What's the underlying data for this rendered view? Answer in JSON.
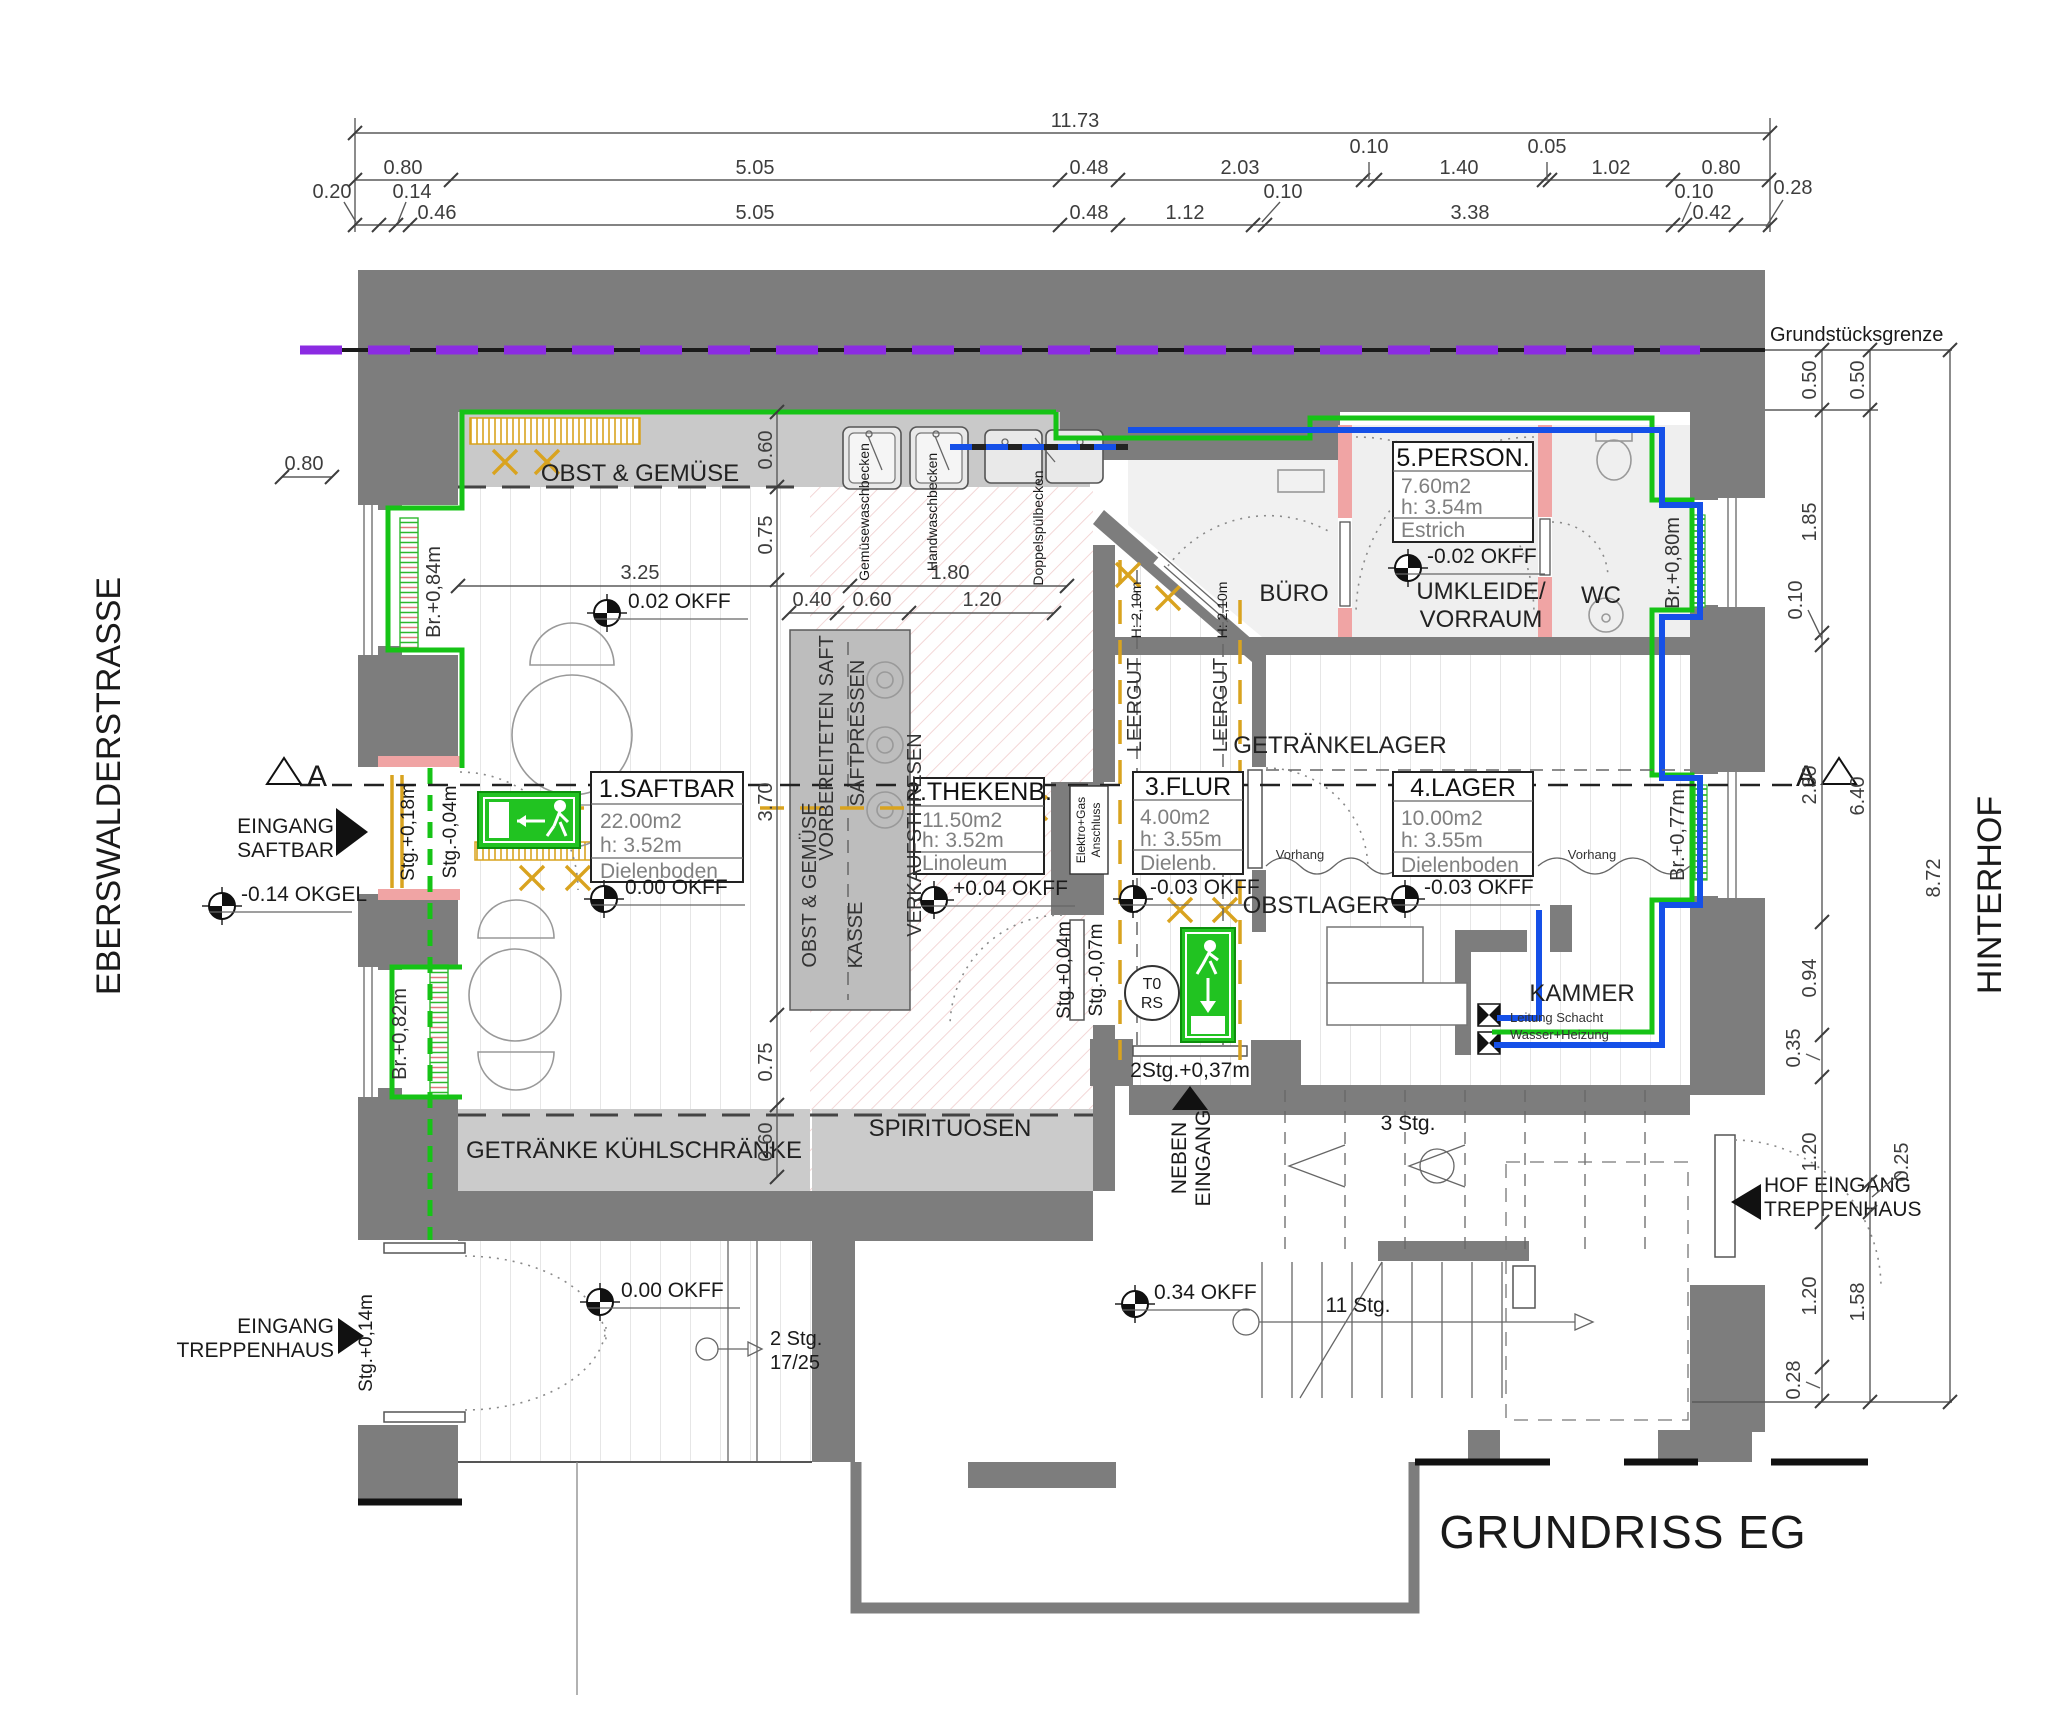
{
  "title": "GRUNDRISS EG",
  "context": {
    "street_left": "EBERSWALDERSTRASSE",
    "street_right": "HINTERHOF",
    "property_line": "Grundstücksgrenze",
    "section": "A"
  },
  "rooms": [
    {
      "name": "1.SAFTBAR",
      "area": "22.00m2",
      "height": "h: 3.52m",
      "floor": "Dielenboden"
    },
    {
      "name": "2.THEKENB.",
      "area": "11.50m2",
      "height": "h: 3.52m",
      "floor": "Linoleum"
    },
    {
      "name": "3.FLUR",
      "area": "4.00m2",
      "height": "h: 3.55m",
      "floor": "Dielenb."
    },
    {
      "name": "4.LAGER",
      "area": "10.00m2",
      "height": "h: 3.55m",
      "floor": "Dielenboden"
    },
    {
      "name": "5.PERSON.",
      "area": "7.60m2",
      "height": "h: 3.54m",
      "floor": "Estrich"
    }
  ],
  "zones": {
    "obst_shelf": "OBST & GEMÜSE",
    "getraenke": "GETRÄNKE KÜHLSCHRÄNKE",
    "spirituosen": "SPIRITUOSEN",
    "vorbereiteten_saft": "VORBEREITETEN SAFT",
    "saftpressen": "SAFTPRESSEN",
    "obst_counter": "OBST & GEMÜSE",
    "kasse": "KASSE",
    "verkaufsthresen": "VERKAUFSTHRESEN",
    "buero": "BÜRO",
    "umkleide": "UMKLEIDE/",
    "vorraum": "VORRAUM",
    "wc": "WC",
    "getraenkelager": "GETRÄNKELAGER",
    "obstlager": "OBSTLAGER",
    "kammer": "KAMMER",
    "leergut": "LEERGUT",
    "leergut_h": "H: 2,10m"
  },
  "fixtures": {
    "sink_gemuese": "Gemüsewaschbecken",
    "sink_hand": "Handwaschbecken",
    "sink_doppel": "Doppelspülbecken",
    "elektro1": "Elektro+Gas",
    "elektro2": "Anschluss",
    "leitung1": "Leitung Schacht",
    "leitung2": "Wasser+Heizung",
    "vorhang": "Vorhang",
    "t0": "T0",
    "rs": "RS"
  },
  "entrances": {
    "saftbar1": "EINGANG",
    "saftbar2": "SAFTBAR",
    "trepp1": "EINGANG",
    "trepp2": "TREPPENHAUS",
    "neben1": "NEBEN",
    "neben2": "EINGANG",
    "hof1": "HOF EINGANG",
    "hof2": "TREPPENHAUS"
  },
  "levels": {
    "okgel": "-0.14 OKGEL",
    "saftbar_02": "0.02 OKFF",
    "saftbar": "0.00 OKFF",
    "theke": "+0.04 OKFF",
    "person": "-0.02 OKFF",
    "flur": "-0.03 OKFF",
    "lager": "-0.03 OKFF",
    "stair": "0.34 OKFF",
    "corridor": "0.00 OKFF"
  },
  "stairs": {
    "three": "3 Stg.",
    "eleven": "11 Stg.",
    "two_a": "2 Stg.",
    "two_b": "17/25",
    "two_plus": "2Stg.+0,37m"
  },
  "marks": {
    "br084": "Br.+0,84m",
    "br082": "Br.+0,82m",
    "br080": "Br.+0,80m",
    "br077": "Br.+0,77m",
    "stg018": "Stg.+0,18m",
    "stgm004": "Stg.-0,04m",
    "stgp004": "Stg.+0,04m",
    "stgm007": "Stg.-0,07m",
    "stgp014": "Stg.+0,14m"
  },
  "dims": {
    "t1": "11.73",
    "t2": [
      "0.80",
      "5.05",
      "0.48",
      "2.03",
      "1.40",
      "1.02",
      "0.80"
    ],
    "t2u": [
      "0.10",
      "0.05"
    ],
    "t3": [
      "0.46",
      "5.05",
      "0.48",
      "1.12",
      "3.38",
      "0.42"
    ],
    "t3u": [
      "0.20",
      "0.14",
      "0.10",
      "0.10",
      "0.28"
    ],
    "r1": [
      "0.50",
      "1.85",
      "0.10",
      "2.30",
      "0.94",
      "0.35",
      "1.20",
      "1.20",
      "0.28"
    ],
    "r2": [
      "0.50",
      "6.40",
      "0.25",
      "1.58"
    ],
    "r3": "8.72",
    "in": [
      "3.25",
      "1.80",
      "0.40",
      "0.60",
      "1.20",
      "0.60",
      "0.75",
      "3.70",
      "0.75",
      "0.60",
      "0.80"
    ]
  }
}
